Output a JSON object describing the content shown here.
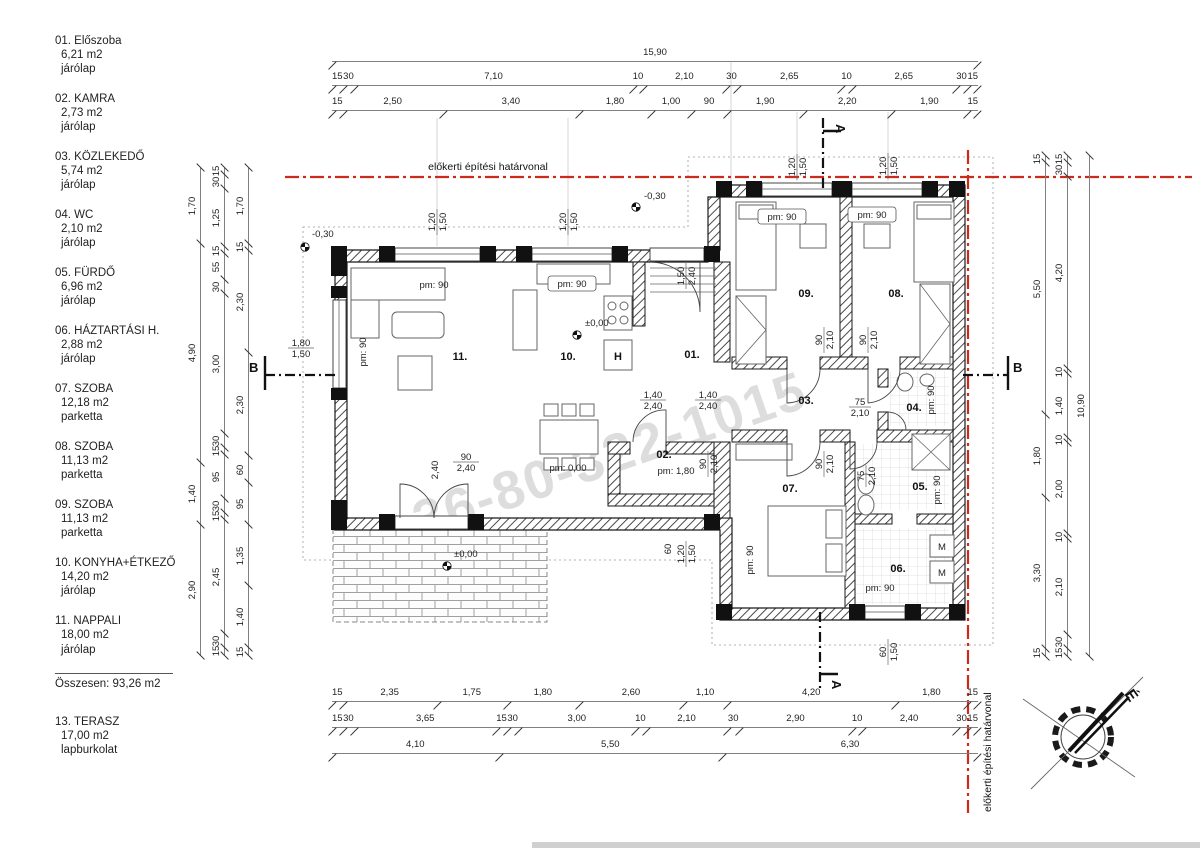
{
  "legend": {
    "rooms": [
      {
        "name": "01. Előszoba",
        "area": "6,21 m2",
        "floor": "járólap"
      },
      {
        "name": "02. KAMRA",
        "area": "2,73 m2",
        "floor": "járólap"
      },
      {
        "name": "03. KÖZLEKEDŐ",
        "area": "5,74 m2",
        "floor": "járólap"
      },
      {
        "name": "04. WC",
        "area": "2,10 m2",
        "floor": "járólap"
      },
      {
        "name": "05. FÜRDŐ",
        "area": "6,96 m2",
        "floor": "járólap"
      },
      {
        "name": "06. HÁZTARTÁSI H.",
        "area": "2,88 m2",
        "floor": "járólap"
      },
      {
        "name": "07. SZOBA",
        "area": "12,18 m2",
        "floor": "parketta"
      },
      {
        "name": "08. SZOBA",
        "area": "11,13 m2",
        "floor": "parketta"
      },
      {
        "name": "09. SZOBA",
        "area": "11,13 m2",
        "floor": "parketta"
      },
      {
        "name": "10. KONYHA+ÉTKEZŐ",
        "area": "14,20  m2",
        "floor": "járólap"
      },
      {
        "name": "11. NAPPALI",
        "area": "18,00  m2",
        "floor": "járólap"
      }
    ],
    "total_label": "Összesen: 93,26 m2",
    "terrace": {
      "name": "13.  TERASZ",
      "area": "17,00 m2",
      "floor": "lapburkolat"
    }
  },
  "boundary_label": "előkerti építési határvonal",
  "boundary_color": "#cc2a1a",
  "watermark": "+36-80-322-1015",
  "compass_label": "É",
  "section_a": "A",
  "section_b": "B",
  "dims": {
    "top_total": [
      "15,90"
    ],
    "top_row2": [
      "15",
      "30",
      "7,10",
      "10",
      "2,10",
      "30",
      "2,65",
      "10",
      "2,65",
      "30",
      "15"
    ],
    "top_row3": [
      "15",
      "2,50",
      "3,40",
      "1,80",
      "1,00",
      "90",
      "1,90",
      "2,20",
      "1,90",
      "15"
    ],
    "bottom_row1": [
      "15",
      "2,35",
      "1,75",
      "1,80",
      "2,60",
      "1,10",
      "4,20",
      "1,80",
      "15"
    ],
    "bottom_row2": [
      "15",
      "30",
      "3,65",
      "15",
      "30",
      "3,00",
      "10",
      "2,10",
      "30",
      "2,90",
      "10",
      "2,40",
      "30",
      "15"
    ],
    "bottom_totals": [
      "4,10",
      "5,50",
      "6,30"
    ],
    "left_outer": [
      "1,70",
      "4,90",
      "1,40",
      "2,90"
    ],
    "left_middle": [
      "15",
      "30",
      "1,25",
      "15",
      "55",
      "30",
      "3,00",
      "30",
      "15",
      "95",
      "30",
      "15",
      "2,45",
      "30",
      "15"
    ],
    "left_inner": [
      "1,70",
      "15",
      "2,30",
      "2,30",
      "60",
      "95",
      "1,35",
      "1,40",
      "15"
    ],
    "right_inner": [
      "15",
      "5,50",
      "1,80",
      "3,30",
      "15"
    ],
    "right_middle": [
      "15",
      "30",
      "4,20",
      "10",
      "1,40",
      "10",
      "2,00",
      "10",
      "2,10",
      "30",
      "15"
    ],
    "right_total": [
      "10,90"
    ]
  },
  "plan": {
    "rooms": {
      "r01": "01.",
      "r02": "02.",
      "r03": "03.",
      "r04": "04.",
      "r05": "05.",
      "r06": "06.",
      "r07": "07.",
      "r08": "08.",
      "r09": "09.",
      "r10": "10.",
      "r11": "11."
    },
    "pm90": "pm: 90",
    "pm180": "pm: 1,80",
    "pm000": "pm: 0,00",
    "elev_zero": "±0,00",
    "elev_minus": "-0,30",
    "h": "H",
    "m": "M",
    "dims": {
      "d120": "1,20",
      "d150": "1,50",
      "d180": "1,80",
      "d240": "2,40",
      "d140": "1,40",
      "d90": "90",
      "d60": "60",
      "d210": "2,10",
      "d75": "75"
    }
  }
}
